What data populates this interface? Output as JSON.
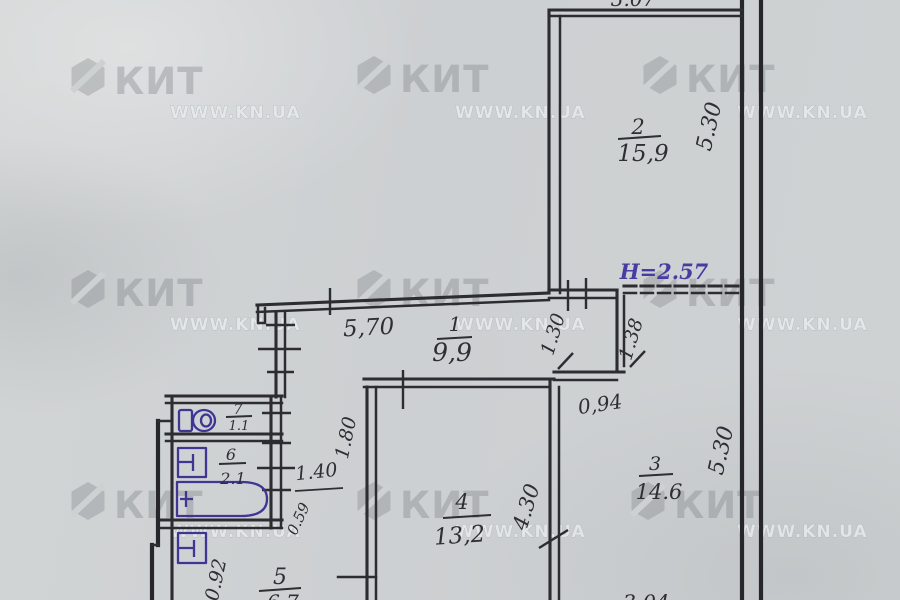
{
  "watermark": {
    "brand": "КИТ",
    "url": "WWW.KN.UA"
  },
  "plan": {
    "ceiling_height": "Н=2.57",
    "rooms": {
      "r1": {
        "num": "1",
        "area": "9,9"
      },
      "r2": {
        "num": "2",
        "area": "15,9"
      },
      "r3": {
        "num": "3",
        "area": "14.6"
      },
      "r4": {
        "num": "4",
        "area": "13,2"
      },
      "r5": {
        "num": "5",
        "area": "6.7"
      },
      "r6": {
        "num": "6",
        "area": "2.1"
      },
      "r7": {
        "num": "7",
        "area": "1.1"
      }
    },
    "dims": {
      "top_width_partial": "3.07",
      "r2_height": "5.30",
      "corridor_width": "5,70",
      "nook_depth": "1.30",
      "closet_depth": "1.38",
      "opening_width": "0,94",
      "r3_height": "5.30",
      "r3_width_partial": "3.04",
      "r4_width": "4.30",
      "hall_depth": "1.80",
      "hall_width": "1.40",
      "hall_pass": "0.59",
      "r5_width": "0.92"
    }
  }
}
